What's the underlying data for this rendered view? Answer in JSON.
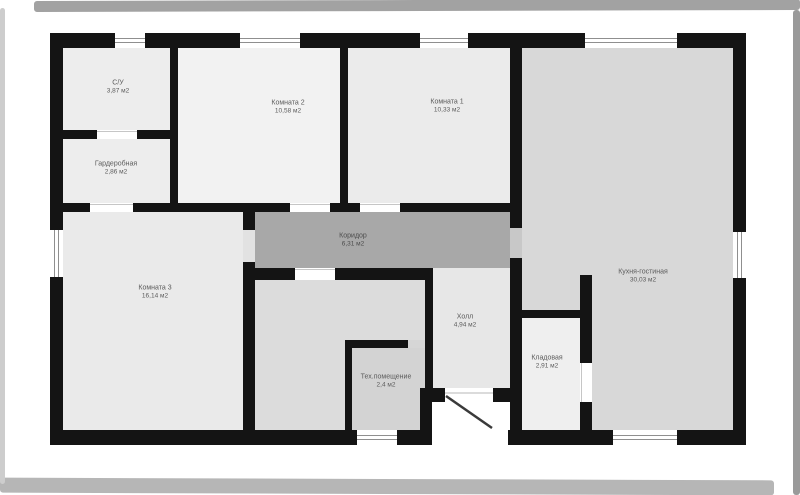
{
  "plan": {
    "type": "floor-plan",
    "units": "м2",
    "rooms": [
      {
        "id": "su",
        "name": "С/У",
        "area": "3,87 м2"
      },
      {
        "id": "garderobnaya",
        "name": "Гардеробная",
        "area": "2,86 м2"
      },
      {
        "id": "komnata2",
        "name": "Комната 2",
        "area": "10,58 м2"
      },
      {
        "id": "komnata1",
        "name": "Комната 1",
        "area": "10,33 м2"
      },
      {
        "id": "komnata3",
        "name": "Комната 3",
        "area": "16,14 м2"
      },
      {
        "id": "koridor",
        "name": "Коридор",
        "area": "6,31 м2"
      },
      {
        "id": "holl",
        "name": "Холл",
        "area": "4,94 м2"
      },
      {
        "id": "kladovaya",
        "name": "Кладовая",
        "area": "2,91 м2"
      },
      {
        "id": "teh",
        "name": "Тех.помещение",
        "area": "2,4 м2"
      },
      {
        "id": "kitchen",
        "name": "Кухня-гостиная",
        "area": "30,03 м2"
      }
    ]
  },
  "colors": {
    "wall": "#141414",
    "room-light": "#ededed",
    "room-medium": "#d8d8d8",
    "corridor": "#a8a8a8",
    "window-line": "#8f8f8f",
    "label-text": "#5b5b5b"
  }
}
